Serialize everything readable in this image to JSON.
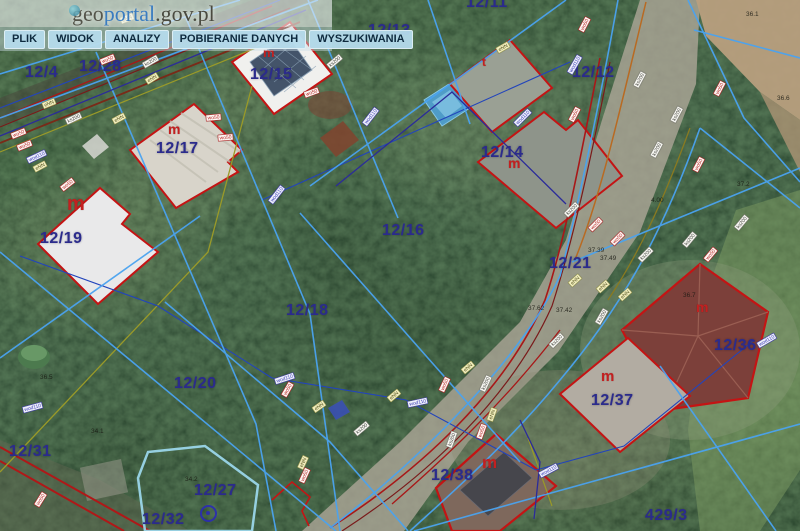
{
  "header": {
    "logo": {
      "geo": "geo",
      "portal": "portal",
      "suffix": ".gov.pl"
    },
    "menu": [
      {
        "label": "PLIK"
      },
      {
        "label": "WIDOK"
      },
      {
        "label": "ANALIZY"
      },
      {
        "label": "POBIERANIE DANYCH"
      },
      {
        "label": "WYSZUKIWANIA"
      }
    ]
  },
  "map": {
    "parcels": [
      {
        "id": "12/4"
      },
      {
        "id": "12/28"
      },
      {
        "id": "12/15"
      },
      {
        "id": "12/13"
      },
      {
        "id": "12/11"
      },
      {
        "id": "12/12"
      },
      {
        "id": "12/17"
      },
      {
        "id": "12/14"
      },
      {
        "id": "12/16"
      },
      {
        "id": "12/19"
      },
      {
        "id": "12/21"
      },
      {
        "id": "12/18"
      },
      {
        "id": "12/36"
      },
      {
        "id": "12/20"
      },
      {
        "id": "12/37"
      },
      {
        "id": "12/31"
      },
      {
        "id": "12/38"
      },
      {
        "id": "12/27"
      },
      {
        "id": "12/32"
      },
      {
        "id": "429/3"
      }
    ],
    "buildings": [
      {
        "label": "m"
      },
      {
        "label": "m"
      },
      {
        "label": "m"
      },
      {
        "label": "t"
      },
      {
        "label": "m"
      },
      {
        "label": "m"
      },
      {
        "label": "m"
      },
      {
        "label": "m"
      }
    ],
    "elevations": [
      {
        "v": "36.1"
      },
      {
        "v": "36.6"
      },
      {
        "v": "37.2"
      },
      {
        "v": "37.39"
      },
      {
        "v": "37.49"
      },
      {
        "v": "4.00"
      },
      {
        "v": "37.62"
      },
      {
        "v": "37.42"
      },
      {
        "v": "34.2"
      },
      {
        "v": "34.1"
      },
      {
        "v": "36.5"
      },
      {
        "v": "36.7"
      }
    ],
    "utility_labels": {
      "wod": "wod110",
      "enn": "eNN",
      "wo": "wo50",
      "ks": "ks200"
    },
    "colors": {
      "parcel_label": "#2b2b8c",
      "building_label": "#c32020",
      "boundary_line": "#4aa3f0",
      "building_outline": "#c41414",
      "selection_highlight": "#9fdcf2"
    }
  }
}
